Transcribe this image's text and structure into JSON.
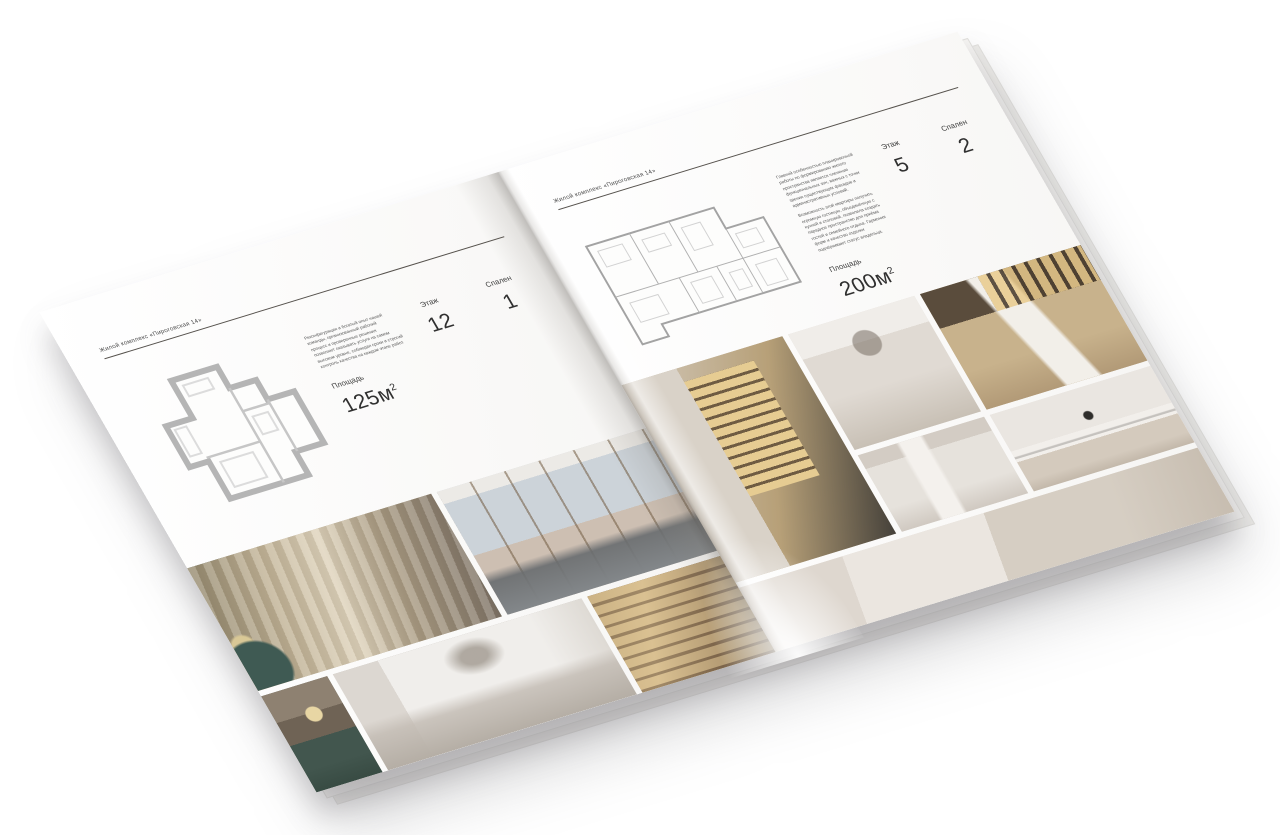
{
  "brochure": {
    "left_page": {
      "header": "Жилой комплекс «Пироговская 14»",
      "description": "Реконфигурация и богатый опыт нашей команды, организованный рабочий процесс и проверенные решения позволяют оказывать услуги на самом высоком уровне, соблюдая сроки и строгий контроль качества на каждом этапе работ.",
      "specs": {
        "area_label": "Площадь",
        "area_value": "125м",
        "area_sup": "2",
        "floor_label": "Этаж",
        "floor_value": "12",
        "bedrooms_label": "Спален",
        "bedrooms_value": "1"
      },
      "photos": {
        "bedroom": {
          "name": "bedroom-with-pillows",
          "css": "background-color:#b3a68c; background-image: radial-gradient(circle at 5% 86%, #3f5a53 0 11%, rgba(63,90,83,0) 12%), radial-gradient(circle at 4% 66%, #d9c896 0 4%, rgba(217,200,150,0) 5%), repeating-linear-gradient(97deg, rgba(255,252,246,0.20) 0 8px, rgba(84,70,52,0.10) 8px 16px), linear-gradient(100deg, #94896f 0%, #c0b296 26%, #ded3bc 48%, #a89a82 70%, #7b7064 100%);"
        },
        "living_room": {
          "name": "living-room-panoramic-windows",
          "css": "background-color:#ccd0d4; background-image: linear-gradient(to bottom, rgba(0,0,0,0) 0 66%, rgba(104,108,111,0.9) 74%, #83878a 100%), repeating-linear-gradient(90deg, rgba(0,0,0,0) 0 34px, rgba(112,90,64,0.55) 34px 36px), linear-gradient(to bottom, #eceae6 0 10%, #ccd3d9 10% 52%, #cdbfb2 52% 70%, #c4b6a8 100%);"
        },
        "dining_nook": {
          "name": "dining-nook-teal-bench",
          "css": "background-color:#5d6258; background-image: radial-gradient(circle at 55% 30%, #e8d6a4 0 9%, rgba(232,214,164,0) 10%), linear-gradient(to bottom, #8e8171 0 28%, #6f6355 28% 52%, #42564e 52% 78%, #384b43 100%);"
        },
        "white_bedroom": {
          "name": "white-bedroom-arc-decor",
          "css": "background-color:#ebe9e6; background-image: radial-gradient(ellipse at 52% 22%, rgba(154,146,136,0.75) 0 7%, rgba(154,146,136,0) 16%), linear-gradient(to bottom, rgba(0,0,0,0) 0 52%, rgba(196,189,181,0.85) 66%, #b5aea5 100%), linear-gradient(to right, #dcd7d1 0 18%, #f0eeeb 18% 78%, #dedad4 100%);"
        },
        "foyer_shelves": {
          "name": "foyer-lit-shelves",
          "css": "background-color:#a88e68; background-image: repeating-linear-gradient(180deg, rgba(240,216,160,0.40) 0 9px, rgba(92,72,50,0.38) 9px 12px), linear-gradient(110deg, #b49a72 0%, #cbb188 32%, #93795b 66%, #6e5c46 100%);"
        }
      }
    },
    "right_page": {
      "header": "Жилой комплекс «Пироговская 14»",
      "description_1": "Главной особенностью планировочной работы по формированию жилого пространства является членение функциональных зон, важных с точки зрения существующих фасадов и административных условий.",
      "description_2": "Возможность этой квартиры получить огромную гостиную, объединённую с кухней и столовой, позволила создать парадное пространство для приёма гостей и семейного отдыха. Гармония форм и качество отделки подчёркивают статус владельца.",
      "specs": {
        "area_label": "Площадь",
        "area_value": "200м",
        "area_sup": "2",
        "floor_label": "Этаж",
        "floor_value": "5",
        "bedrooms_label": "Спален",
        "bedrooms_value": "2"
      },
      "photos": {
        "dressing_room": {
          "name": "dressing-room-glass-wardrobe",
          "css": "background-color:#c6bba9; background-image: linear-gradient(to right, #d9d2c8 0 34%, rgba(0,0,0,0) 34%), repeating-linear-gradient(180deg, #e6cc92 0 8px, #6f5c42 8px 11px), linear-gradient(115deg, #d3cabd 0%, #b7a078 56%, #45413a 100%); background-size: 100% 100%, 46% 58%, 100% 100%; background-position: 0 0, 58% 16%, 0 0; background-repeat: no-repeat;"
        },
        "bathroom_vanity": {
          "name": "bathroom-vanity-mirror",
          "css": "background-color:#ddd7cf; background-image: radial-gradient(circle at 50% 24%, rgba(118,108,98,0.55) 0 11%, rgba(118,108,98,0) 12%), linear-gradient(to bottom, #f0ede9 0 22%, #e0dad3 22% 58%, #c8c0b5 100%);"
        },
        "study": {
          "name": "study-gold-leg-desk",
          "css": "background-color:#b7a17d; background-image: repeating-linear-gradient(90deg, rgba(232,202,140,0.85) 0 9px, rgba(77,64,49,0.9) 9px 13px), linear-gradient(75deg, rgba(0,0,0,0) 40%, #f2efe9 42% 58%, rgba(0,0,0,0) 60%), linear-gradient(to bottom, #5a4c3c 0 30%, #c8b28c 30% 68%, #b29a77 100%); background-size: 64% 30%, 100% 100%, 100% 100%; background-position: 100% 0, 0 0, 0 0; background-repeat: no-repeat;"
        },
        "towel_bath": {
          "name": "bathroom-towel-rail",
          "css": "background-color:#ded9d2; background-image: linear-gradient(to right, rgba(0,0,0,0) 30%, #f4f1ed 33% 49%, rgba(0,0,0,0) 52%), linear-gradient(to bottom, #d3ccc4 0 18%, #e6e2dc 18% 70%, #d0c9c1 100%);"
        },
        "kitchen_island": {
          "name": "kitchen-marble-island",
          "css": "background-color:#e4dfd9; background-image: radial-gradient(circle at 52% 34%, #2f2d2b 0 4%, rgba(47,45,43,0) 5%), linear-gradient(to bottom, rgba(0,0,0,0) 55%, rgba(63,60,56,0.25) 56% 58%, rgba(0,0,0,0) 58%), linear-gradient(to bottom, #eae6e1 0 48%, #f2efeb 48% 62%, #d4cabd 62% 86%, #c3b8aa 100%);"
        },
        "bottom_strip": {
          "name": "bathroom-suite-panorama",
          "css": "background-color:#ddd6cd; background-image: linear-gradient(100deg, #ded7cf 0 22%, #ebe6e0 22% 52%, #d6cec3 52% 78%, #c7bdb0 100%);"
        }
      }
    }
  }
}
